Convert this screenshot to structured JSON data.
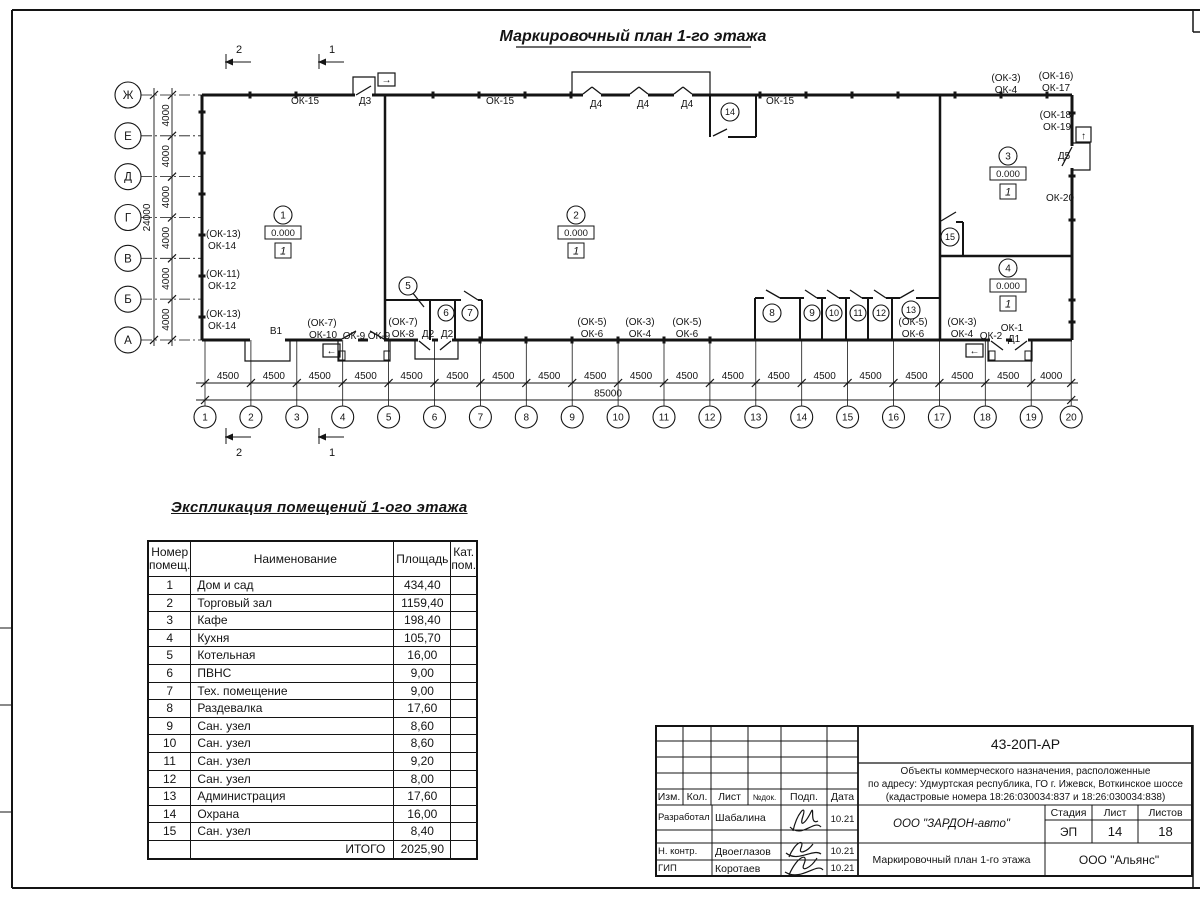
{
  "sheet": {
    "plan_title": "Маркировочный план 1-го этажа",
    "table_title": "Экспликация помещений 1-ого этажа"
  },
  "plan": {
    "axes_rows": [
      "Ж",
      "Е",
      "Д",
      "Г",
      "В",
      "Б",
      "А"
    ],
    "axes_cols": [
      "1",
      "2",
      "3",
      "4",
      "5",
      "6",
      "7",
      "8",
      "9",
      "10",
      "11",
      "12",
      "13",
      "14",
      "15",
      "16",
      "17",
      "18",
      "19",
      "20"
    ],
    "dim_row_segment": "4000",
    "dim_row_total": "24000",
    "dim_col_segments": [
      "4500",
      "4500",
      "4500",
      "4500",
      "4500",
      "4500",
      "4500",
      "4500",
      "4500",
      "4500",
      "4500",
      "4500",
      "4500",
      "4500",
      "4500",
      "4500",
      "4500",
      "4500",
      "4000"
    ],
    "dim_col_total": "85000",
    "elevation": "0.000",
    "floor_type": "1",
    "sections": [
      {
        "t": "2",
        "tip": 225
      },
      {
        "t": "1",
        "tip": 318
      }
    ],
    "rooms_elev": [
      {
        "num": "1",
        "x": 283,
        "y": 215
      },
      {
        "num": "2",
        "x": 576,
        "y": 215
      },
      {
        "num": "3",
        "x": 1008,
        "y": 156
      },
      {
        "num": "4",
        "x": 1008,
        "y": 268
      }
    ],
    "rooms": [
      {
        "num": "5",
        "x": 408,
        "y": 286,
        "r": 9
      },
      {
        "num": "6",
        "x": 446,
        "y": 313,
        "r": 8
      },
      {
        "num": "7",
        "x": 470,
        "y": 313,
        "r": 8
      },
      {
        "num": "8",
        "x": 772,
        "y": 313,
        "r": 9
      },
      {
        "num": "9",
        "x": 812,
        "y": 313,
        "r": 8
      },
      {
        "num": "10",
        "x": 834,
        "y": 313,
        "r": 8
      },
      {
        "num": "11",
        "x": 858,
        "y": 313,
        "r": 8
      },
      {
        "num": "12",
        "x": 881,
        "y": 313,
        "r": 8
      },
      {
        "num": "13",
        "x": 911,
        "y": 310,
        "r": 9
      },
      {
        "num": "14",
        "x": 730,
        "y": 112,
        "r": 9
      },
      {
        "num": "15",
        "x": 950,
        "y": 237,
        "r": 9
      }
    ],
    "labels": [
      {
        "t": "ОК-15",
        "x": 305,
        "y": 104
      },
      {
        "t": "Д3",
        "x": 365,
        "y": 104
      },
      {
        "t": "ОК-15",
        "x": 500,
        "y": 104
      },
      {
        "t": "Д4",
        "x": 596,
        "y": 107
      },
      {
        "t": "Д4",
        "x": 643,
        "y": 107
      },
      {
        "t": "Д4",
        "x": 687,
        "y": 107
      },
      {
        "t": "ОК-15",
        "x": 780,
        "y": 104
      },
      {
        "t": "(ОК-3)",
        "x": 1006,
        "y": 81
      },
      {
        "t": "ОК-4",
        "x": 1006,
        "y": 93
      },
      {
        "t": "(ОК-16)",
        "x": 1056,
        "y": 79
      },
      {
        "t": "ОК-17",
        "x": 1056,
        "y": 91
      },
      {
        "t": "(ОК-18)",
        "x": 1057,
        "y": 118
      },
      {
        "t": "ОК-19",
        "x": 1057,
        "y": 130
      },
      {
        "t": "Д5",
        "x": 1064,
        "y": 159
      },
      {
        "t": "ОК-20",
        "x": 1060,
        "y": 201
      },
      {
        "t": "(ОК-13)",
        "x": 206,
        "y": 237,
        "anchor": "start"
      },
      {
        "t": "ОК-14",
        "x": 208,
        "y": 249,
        "anchor": "start"
      },
      {
        "t": "(ОК-11)",
        "x": 206,
        "y": 277,
        "anchor": "start"
      },
      {
        "t": "ОК-12",
        "x": 208,
        "y": 289,
        "anchor": "start"
      },
      {
        "t": "(ОК-13)",
        "x": 206,
        "y": 317,
        "anchor": "start"
      },
      {
        "t": "ОК-14",
        "x": 208,
        "y": 329,
        "anchor": "start"
      },
      {
        "t": "В1",
        "x": 276,
        "y": 334
      },
      {
        "t": "(ОК-7)",
        "x": 322,
        "y": 326
      },
      {
        "t": "ОК-10",
        "x": 323,
        "y": 338
      },
      {
        "t": "ОК-9",
        "x": 354,
        "y": 339
      },
      {
        "t": "ОК-9",
        "x": 379,
        "y": 339
      },
      {
        "t": "(ОК-7)",
        "x": 403,
        "y": 325
      },
      {
        "t": "ОК-8",
        "x": 403,
        "y": 337
      },
      {
        "t": "Д2",
        "x": 428,
        "y": 337
      },
      {
        "t": "Д2",
        "x": 447,
        "y": 337
      },
      {
        "t": "(ОК-5)",
        "x": 592,
        "y": 325
      },
      {
        "t": "ОК-6",
        "x": 592,
        "y": 337
      },
      {
        "t": "(ОК-3)",
        "x": 640,
        "y": 325
      },
      {
        "t": "ОК-4",
        "x": 640,
        "y": 337
      },
      {
        "t": "(ОК-5)",
        "x": 687,
        "y": 325
      },
      {
        "t": "ОК-6",
        "x": 687,
        "y": 337
      },
      {
        "t": "(ОК-5)",
        "x": 913,
        "y": 325
      },
      {
        "t": "ОК-6",
        "x": 913,
        "y": 337
      },
      {
        "t": "(ОК-3)",
        "x": 962,
        "y": 325
      },
      {
        "t": "ОК-4",
        "x": 962,
        "y": 337
      },
      {
        "t": "ОК-2",
        "x": 991,
        "y": 339
      },
      {
        "t": "ОК-1",
        "x": 1012,
        "y": 331
      },
      {
        "t": "Д1",
        "x": 1014,
        "y": 342
      }
    ],
    "entry_arrows": {
      "right": "→",
      "left": "←",
      "up": "↑"
    }
  },
  "explication": {
    "headers": {
      "num_l1": "Номер",
      "num_l2": "помещ.",
      "name": "Наименование",
      "area": "Площадь",
      "cat_l1": "Кат.",
      "cat_l2": "пом."
    },
    "rows": [
      [
        "1",
        "Дом и сад",
        "434,40"
      ],
      [
        "2",
        "Торговый зал",
        "1159,40"
      ],
      [
        "3",
        "Кафе",
        "198,40"
      ],
      [
        "4",
        "Кухня",
        "105,70"
      ],
      [
        "5",
        "Котельная",
        "16,00"
      ],
      [
        "6",
        "ПВНС",
        "9,00"
      ],
      [
        "7",
        "Тех. помещение",
        "9,00"
      ],
      [
        "8",
        "Раздевалка",
        "17,60"
      ],
      [
        "9",
        "Сан. узел",
        "8,60"
      ],
      [
        "10",
        "Сан. узел",
        "8,60"
      ],
      [
        "11",
        "Сан. узел",
        "9,20"
      ],
      [
        "12",
        "Сан. узел",
        "8,00"
      ],
      [
        "13",
        "Администрация",
        "17,60"
      ],
      [
        "14",
        "Охрана",
        "16,00"
      ],
      [
        "15",
        "Сан. узел",
        "8,40"
      ]
    ],
    "total_label": "ИТОГО",
    "total_value": "2025,90"
  },
  "titleblock": {
    "doc": "43-20П-АР",
    "desc1": "Объекты коммерческого назначения, расположенные",
    "desc2": "по адресу: Удмуртская республика, ГО г. Ижевск, Воткинское шоссе",
    "desc3": "(кадастровые номера 18:26:030034:837 и 18:26:030034:838)",
    "col_izm": "Изм.",
    "col_kol": "Кол.",
    "col_list": "Лист",
    "col_doc": "№док.",
    "col_podp": "Подп.",
    "col_data": "Дата",
    "rows": [
      {
        "role": "Разработал",
        "name": "Шабалина",
        "date": "10.21"
      },
      {
        "role": "Н. контр.",
        "name": "Двоеглазов",
        "date": "10.21"
      },
      {
        "role": "ГИП",
        "name": "Коротаев",
        "date": "10.21"
      }
    ],
    "company": "ООО \"ЗАРДОН-авто\"",
    "stage_label": "Стадия",
    "sheet_label": "Лист",
    "sheets_label": "Листов",
    "stage": "ЭП",
    "sheet_num": "14",
    "sheets_total": "18",
    "plan_name": "Маркировочный план 1-го этажа",
    "org": "ООО \"Альянс\""
  }
}
